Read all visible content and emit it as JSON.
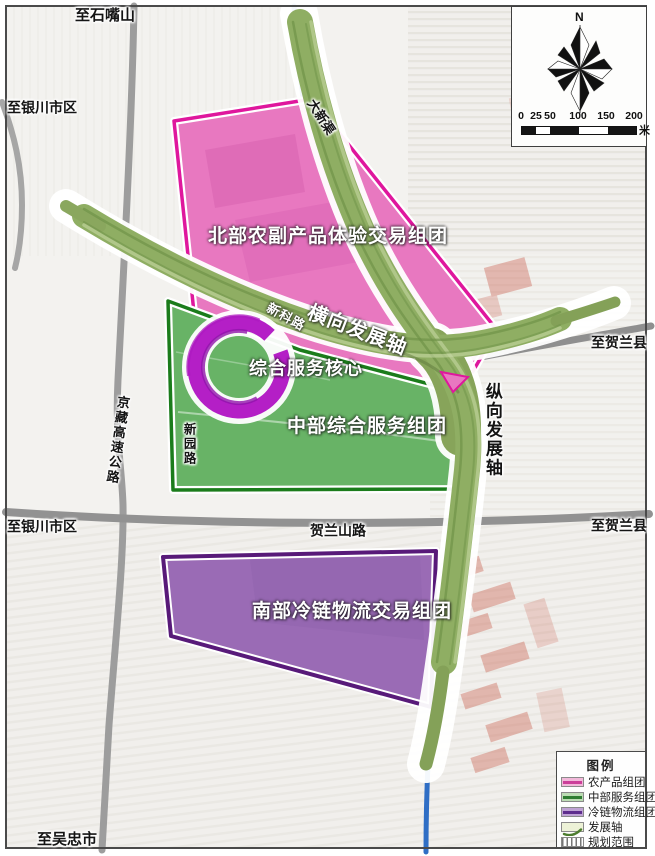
{
  "place_labels": {
    "to_shizuishan": "至石嘴山",
    "to_yinchuan_top": "至银川市区",
    "to_yinchuan_mid": "至银川市区",
    "to_wuzhong": "至吴忠市",
    "to_helan_upper": "至贺兰县",
    "to_helan_lower": "至贺兰县"
  },
  "road_labels": {
    "daxin_canal": "大新渠",
    "xinke_road": "新科路",
    "xinyuan_road": "新园路",
    "jingzang_expressway": "京藏高速公路",
    "helanshan_road": "贺兰山路"
  },
  "region_labels": {
    "north_cluster": "北部农副产品体验交易组团",
    "central_cluster": "中部综合服务组团",
    "south_cluster": "南部冷链物流交易组团",
    "service_core": "综合服务核心"
  },
  "axis_labels": {
    "horizontal_axis": "横向发展轴",
    "vertical_axis": "纵向发展轴"
  },
  "compass": {
    "north": "N"
  },
  "scalebar": {
    "ticks": [
      "0",
      "25",
      "50",
      "100",
      "150",
      "200"
    ],
    "unit": "米"
  },
  "legend": {
    "title": "图例",
    "items": [
      {
        "label": "农产品组团",
        "fill": "#f2b8da",
        "line": "#cc3f9a"
      },
      {
        "label": "中部服务组团",
        "fill": "#bcdcb4",
        "line": "#2e7d32"
      },
      {
        "label": "冷链物流组团",
        "fill": "#bfa3d4",
        "line": "#5e2d8e"
      },
      {
        "label": "发展轴",
        "fill": "#edf2d7",
        "line": "#4d7d2f"
      },
      {
        "label": "规划范围",
        "fill": "#ffffff",
        "line": "#666666"
      }
    ]
  },
  "colors": {
    "pink_fill": "#e878c0",
    "pink_outline": "#df179d",
    "green_fill": "#68b366",
    "green_outline": "#1b7c1b",
    "purple_fill": "#9a6bb5",
    "purple_outline": "#581a79",
    "axis_green": "#8fae63",
    "core_ring": "#b41fc6",
    "canal_blue": "#2f6ec5",
    "road_gray": "#9d9d9d"
  }
}
